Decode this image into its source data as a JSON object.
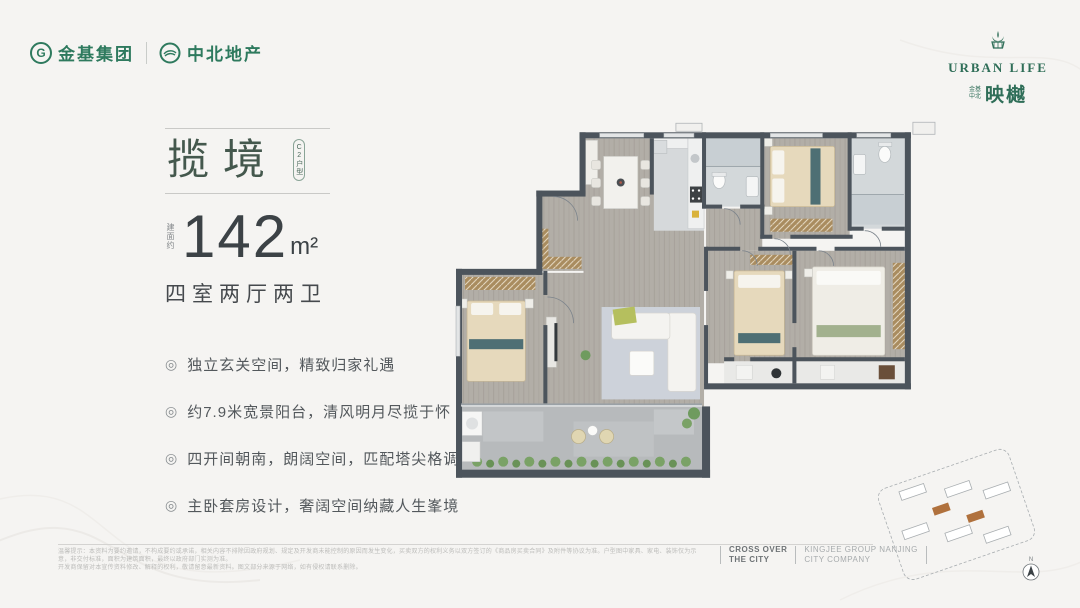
{
  "header": {
    "logo1": "金基集团",
    "logo1_icon_letter": "G",
    "logo2": "中北地产",
    "urban_life": "URBAN LIFE",
    "subbrand_small_top": "金基",
    "subbrand_small_bottom": "中北",
    "subbrand": "映樾"
  },
  "headline": {
    "title": "揽境",
    "unit_badge": "C2户型",
    "area_prefix": "建面约",
    "area_value": "142",
    "area_unit": "m²",
    "layout": "四室两厅两卫"
  },
  "features": [
    {
      "icon": "◎",
      "text": "独立玄关空间，精致归家礼遇"
    },
    {
      "icon": "◎",
      "text": "约7.9米宽景阳台，清风明月尽揽于怀"
    },
    {
      "icon": "◎",
      "text": "四开间朝南，朗阔空间，匹配塔尖格调"
    },
    {
      "icon": "◎",
      "text": "主卧套房设计，奢阔空间纳藏人生峯境"
    }
  ],
  "footer": {
    "disclaimer_line1": "温馨提示：本资料为要约邀请，不构成要约或承诺，相关内容不排除因政府规划、规定及开发商未能控制的原因而发生变化，买卖双方的权利义务以双方签订的《商品房买卖合同》及附件等协议为准。户型图中家具、家电、装饰仅为示意，非交付标准，面积为建筑面积，最终以政府部门实测为准。",
    "disclaimer_line2": "开发商保留对本宣传资料修改、解释的权利，敬请留意最新资料。图文部分来源于网络，如有侵权请联系删除。",
    "slogan_line1": "CROSS OVER",
    "slogan_line2": "THE CITY",
    "company_line1": "KINGJEE GROUP NANJING",
    "company_line2": "CITY COMPANY"
  },
  "siteplan": {
    "compass_label": "N"
  },
  "colors": {
    "brand_green": "#2e7a5e",
    "title_green": "#44584d",
    "text_dark": "#3c4246",
    "wall_gray": "#4c545c",
    "accent_orange": "#b0713d"
  }
}
